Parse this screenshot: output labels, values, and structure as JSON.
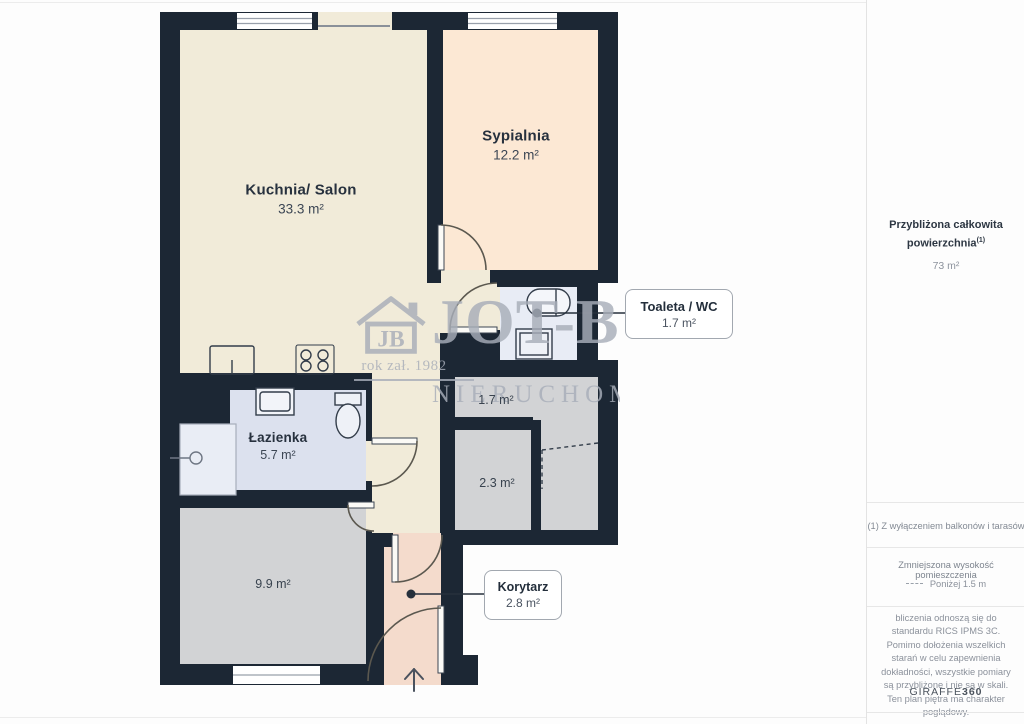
{
  "plan": {
    "kuchnia": {
      "name": "Kuchnia/ Salon",
      "area": "33.3 m²"
    },
    "sypialnia": {
      "name": "Sypialnia",
      "area": "12.2 m²"
    },
    "toaleta": {
      "name": "Toaleta / WC",
      "area": "1.7 m²"
    },
    "lazienka": {
      "name": "Łazienka",
      "area": "5.7 m²"
    },
    "pokoj": {
      "area": "9.9 m²"
    },
    "schowek_gorny": {
      "area": "1.7 m²"
    },
    "schowek_dolny": {
      "area": "2.3 m²"
    },
    "korytarz": {
      "name": "Korytarz",
      "area": "2.8 m²"
    }
  },
  "watermark": {
    "logo_initials": "JB",
    "brand": "JOT-B",
    "established": "rok zał. 1982",
    "line2": "NIERUCHOMO"
  },
  "sidebar": {
    "total": {
      "title_line1": "Przybliżona całkowita",
      "title_line2": "powierzchnia",
      "superscript": "(1)",
      "value": "73 m²"
    },
    "footnote": "(1) Z wyłączeniem balkonów i tarasów",
    "reduced_height": {
      "title": "Zmniejszona wysokość pomieszczenia",
      "value": "Poniżej 1.5 m"
    },
    "disclaimer": "bliczenia odnoszą się do standardu RICS IPMS 3C. Pomimo dołożenia wszelkich starań w celu zapewnienia dokładności, wszystkie pomiary są przybliżone i nie są w skali. Ten plan piętra ma charakter poglądowy.",
    "brand": "GIRAFFE",
    "brand_suffix": "360"
  },
  "colors": {
    "wall": "#1c2734",
    "kitchen": "#f1ebd9",
    "bedroom": "#fce8d4",
    "toilet": "#e8ecf5",
    "bathroom": "#dce1ee",
    "gray_room": "#d2d3d5",
    "corridor_pink": "#f4dbcc",
    "watermark_gray": "#a8aeb9"
  }
}
